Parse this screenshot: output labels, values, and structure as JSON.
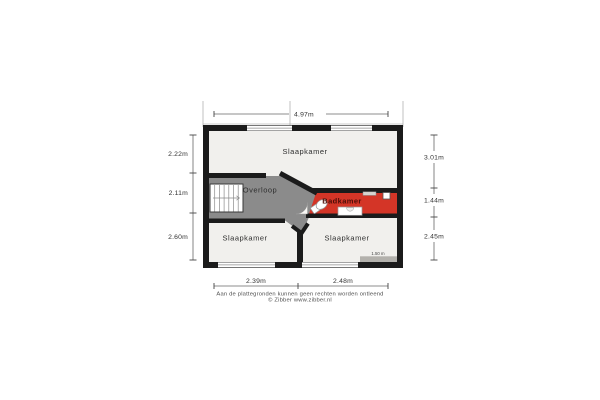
{
  "plan": {
    "rooms": {
      "bedroom_top": "Slaapkamer",
      "landing": "Overloop",
      "bathroom": "Badkamer",
      "bedroom_bottom_left": "Slaapkamer",
      "bedroom_bottom_right": "Slaapkamer"
    },
    "dimensions": {
      "width_total": "4.97m",
      "left": [
        "2.22m",
        "2.11m",
        "2.60m"
      ],
      "right": [
        "3.01m",
        "1.44m",
        "2.45m"
      ],
      "bottom": [
        "2.39m",
        "2.48m"
      ]
    },
    "height_line_label": "1.50 m",
    "colors": {
      "wall": "#1b1b1b",
      "floor": "#f1f0ed",
      "landing": "#8b8b8b",
      "bathroom": "#d43527"
    }
  },
  "footer": {
    "disclaimer": "Aan de plattegronden kunnen geen rechten worden ontleend",
    "credit": "© Zibber www.zibber.nl"
  }
}
